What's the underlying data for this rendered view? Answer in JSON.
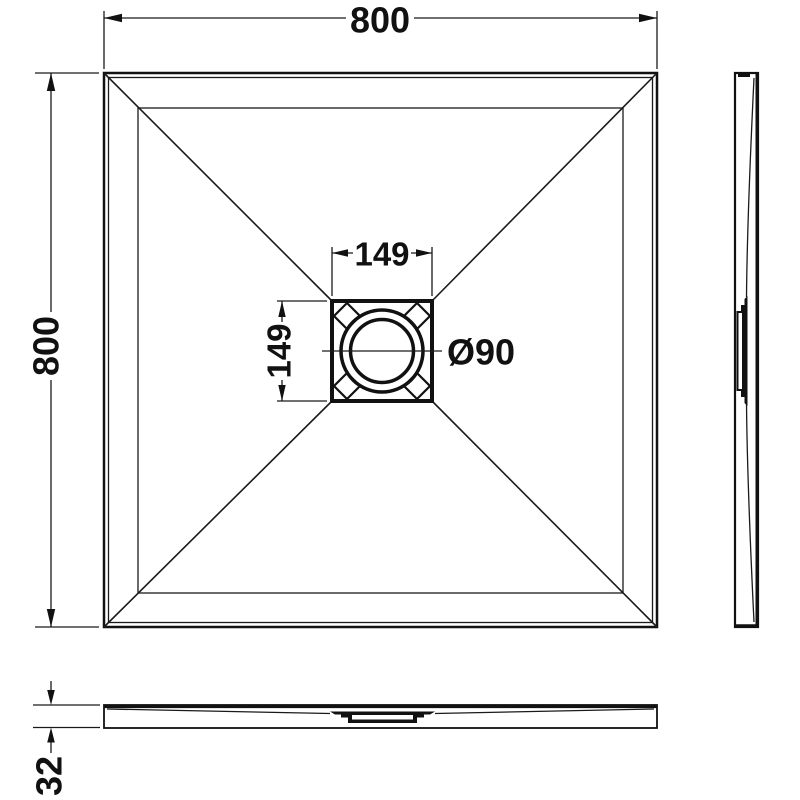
{
  "drawing": {
    "type": "technical-drawing",
    "subject": "square shower tray with center waste drain, plan view with right-side and front profile views",
    "colors": {
      "line": "#111111",
      "background": "#ffffff"
    }
  },
  "dimensions": {
    "plan_width": "800",
    "plan_height": "800",
    "drain_width": "149",
    "drain_height": "149",
    "drain_diameter": "Ø90",
    "tray_thickness": "32"
  }
}
